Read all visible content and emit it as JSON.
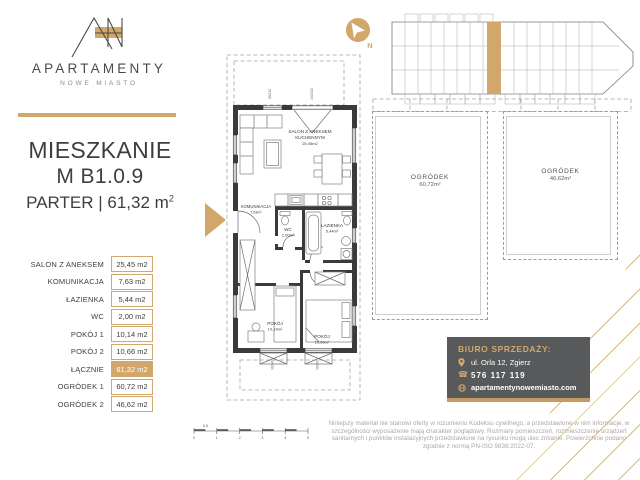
{
  "brand": {
    "name": "APARTAMENTY",
    "subtitle": "NOWE MIASTO"
  },
  "header": {
    "line1": "MIESZKANIE",
    "line2": "M B1.0.9",
    "line3": "PARTER | 61,32 m",
    "sup": "2"
  },
  "areas": {
    "rows": [
      {
        "label": "SALON Z ANEKSEM",
        "value": "25,45 m2"
      },
      {
        "label": "KOMUNIKACJA",
        "value": "7,63 m2"
      },
      {
        "label": "ŁAZIENKA",
        "value": "5,44 m2"
      },
      {
        "label": "WC",
        "value": "2,00 m2"
      },
      {
        "label": "POKÓJ 1",
        "value": "10,14 m2"
      },
      {
        "label": "POKÓJ 2",
        "value": "10,66 m2"
      },
      {
        "label": "ŁĄCZNIE",
        "value": "61,32 m2",
        "highlight": true
      },
      {
        "label": "OGRÓDEK 1",
        "value": "60,72 m2"
      },
      {
        "label": "OGRÓDEK 2",
        "value": "46,62 m2"
      }
    ]
  },
  "plan": {
    "rooms": {
      "salon": {
        "l1": "SALON Z ANEKSEM",
        "l2": "KUCHENNYM",
        "area": "25,45m2"
      },
      "komunikacja": {
        "l1": "KOMUNIKACJA",
        "area": "7,63m²"
      },
      "wc": {
        "l1": "WC",
        "area": "2,00m²"
      },
      "lazienka": {
        "l1": "ŁAZIENKA",
        "area": "5,44m²"
      },
      "pokoj1": {
        "l1": "POKÓJ",
        "area": "10,14m²"
      },
      "pokoj2": {
        "l1": "POKÓJ",
        "area": "10,66m²"
      }
    },
    "dims": {
      "tl": "80/210",
      "tr": "240/210",
      "bl": "90/240",
      "br": "90/240"
    },
    "north_label": "N",
    "scale_ticks": [
      "0",
      "1",
      "2",
      "3",
      "4",
      "5"
    ],
    "scale_half": "0,5"
  },
  "gardens": {
    "g1": {
      "name": "OGRÓDEK",
      "area": "60,72m²"
    },
    "g2": {
      "name": "OGRÓDEK",
      "area": "46,62m²"
    }
  },
  "office": {
    "title": "BIURO SPRZEDAŻY:",
    "address": "ul. Orla 12, Zgierz",
    "phone": "576 117 119",
    "website": "apartamentynowemiasto.com"
  },
  "footer": {
    "disclaimer": "Niniejszy materiał nie stanowi oferty w rozumieniu Kodeksu cywilnego, a przedstawione w nim informacje, w szczególności wyposażenie mają charakter poglądowy. Rozmiary pomieszczeń, rozmieszczenie urządzeń sanitarnych i punktów instalacyjnych przedstawione na rysunku mogą ulec zmianie. Powierzchnie podano zgodnie z normą PN-ISO 9836:2022-07."
  },
  "colors": {
    "gold": "#D2A76B",
    "box_gray": "#58595B",
    "text_dark": "#3E3E3D"
  }
}
